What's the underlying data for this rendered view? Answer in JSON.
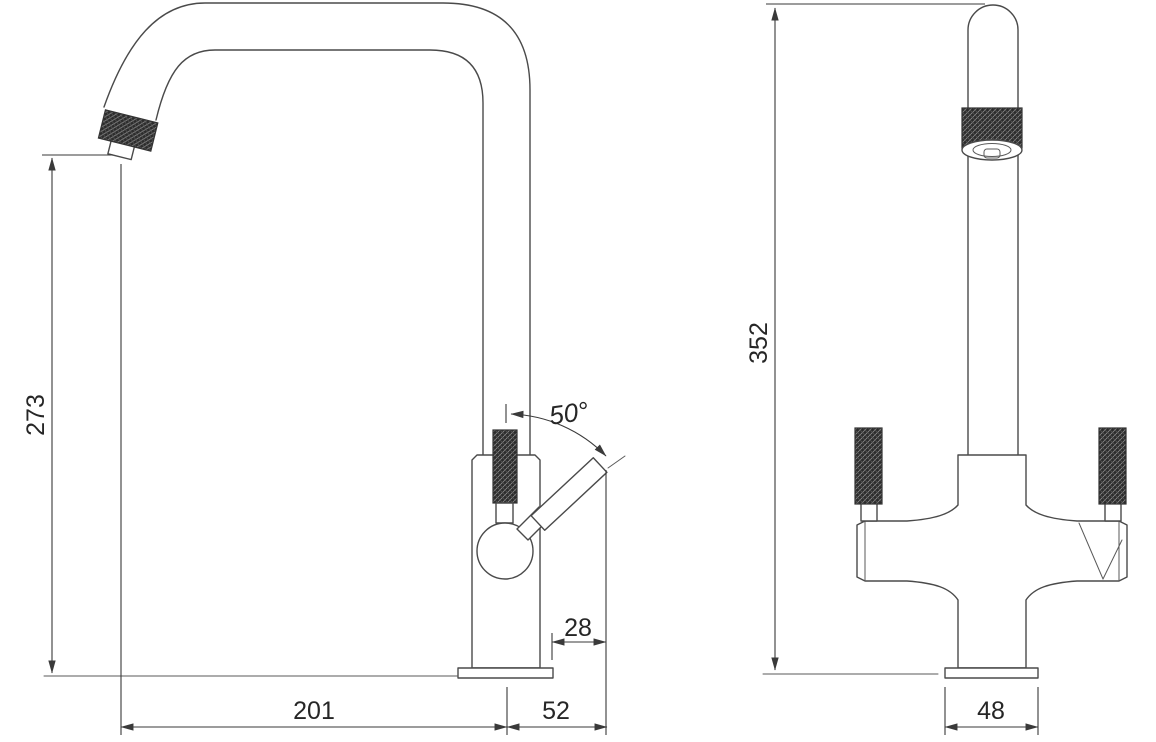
{
  "page": {
    "background": "#ffffff"
  },
  "colors": {
    "line": "#4a4a4a",
    "dimension_line": "#3a3a3a",
    "label_text": "#262626",
    "knurl_dark": "#2c2c2c"
  },
  "views": {
    "side": {
      "dims": {
        "spout_height": "273",
        "reach": "201",
        "handle_projection": "52",
        "handle_overhang": "28",
        "handle_angle": "50°"
      }
    },
    "front": {
      "dims": {
        "overall_height": "352",
        "base_width": "48"
      }
    }
  }
}
